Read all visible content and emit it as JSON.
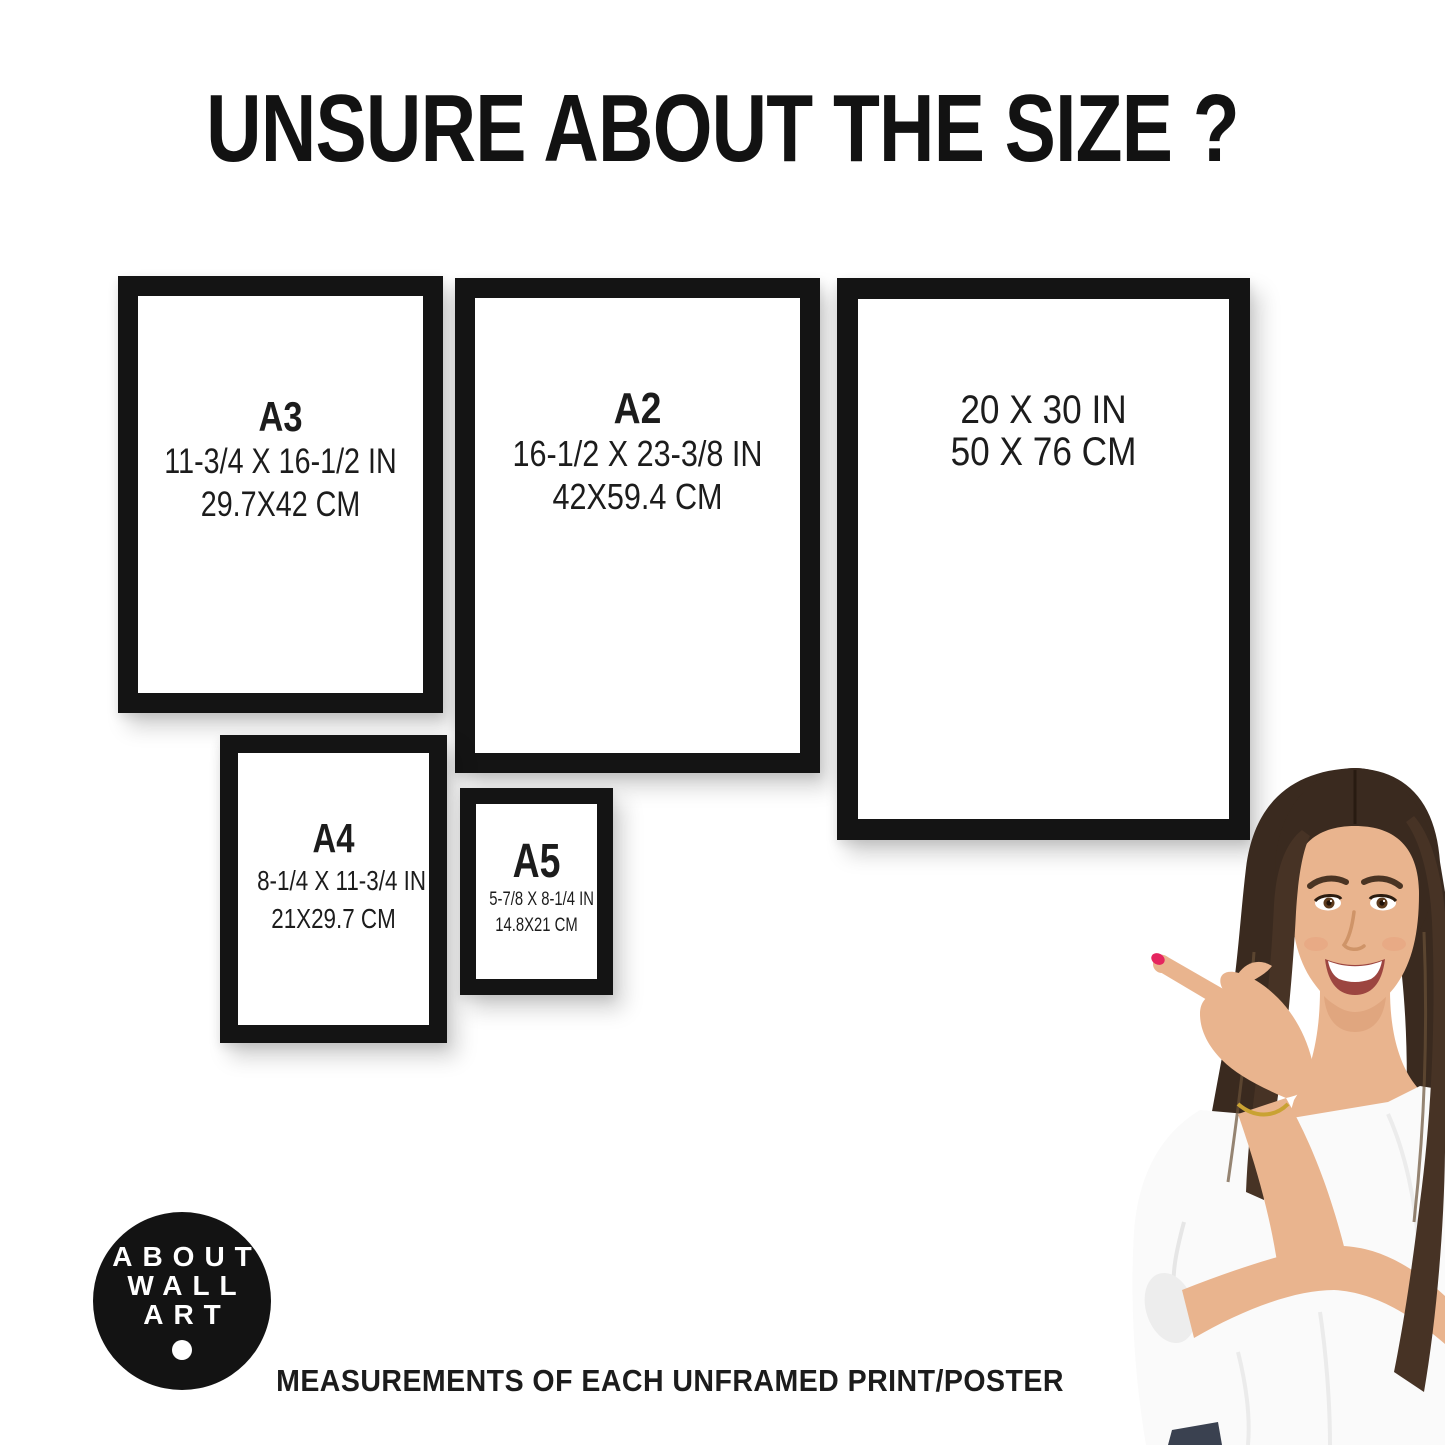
{
  "page": {
    "title": "UNSURE ABOUT THE SIZE ?",
    "footer_caption": "MEASUREMENTS OF EACH UNFRAMED PRINT/POSTER"
  },
  "frames": [
    {
      "name": "A3",
      "label": "A3",
      "inches": "11-3/4 X 16-1/2 IN",
      "cm": "29.7X42 CM"
    },
    {
      "name": "A2",
      "label": "A2",
      "inches": "16-1/2 X 23-3/8 IN",
      "cm": "42X59.4 CM"
    },
    {
      "name": "20x30",
      "label": "",
      "inches": "20 X 30 IN",
      "cm": "50 X 76 CM"
    },
    {
      "name": "A4",
      "label": "A4",
      "inches": "8-1/4 X 11-3/4 IN",
      "cm": "21X29.7 CM"
    },
    {
      "name": "A5",
      "label": "A5",
      "inches": "5-7/8 X 8-1/4 IN",
      "cm": "14.8X21 CM"
    }
  ],
  "logo": {
    "line1": "ABOUT",
    "line2": "WALL",
    "line3": "ART"
  },
  "colors": {
    "background": "#ffffff",
    "frame": "#141414",
    "text": "#1c1c1c",
    "logo_bg": "#131313",
    "logo_text": "#ffffff",
    "hair": "#3a2a1f",
    "skin": "#e9b48e",
    "blouse": "#fafafa",
    "nail": "#e5255f",
    "bracelet": "#c9a233",
    "jeans": "#3a4150"
  }
}
